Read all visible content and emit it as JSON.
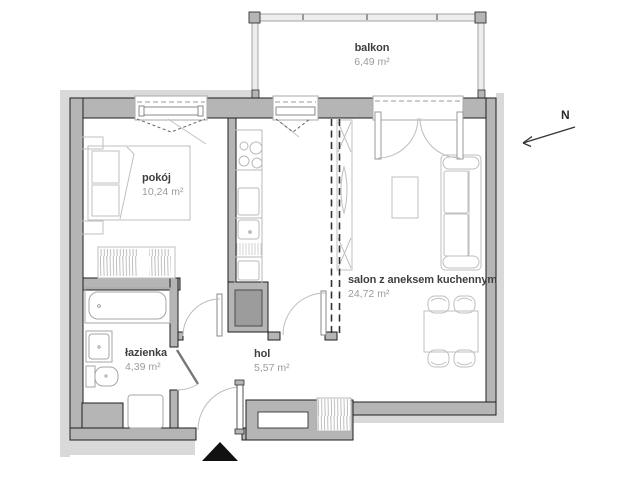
{
  "plan": {
    "rooms": {
      "balkon": {
        "name": "balkon",
        "area": "6,49 m²"
      },
      "pokoj": {
        "name": "pokój",
        "area": "10,24 m²"
      },
      "salon": {
        "name": "salon z aneksem kuchennym",
        "area": "24,72 m²"
      },
      "lazienka": {
        "name": "łazienka",
        "area": "4,39 m²"
      },
      "hol": {
        "name": "hol",
        "area": "5,57 m²"
      }
    },
    "compass": {
      "label": "N"
    },
    "colors": {
      "wall_fill": "#b5b5b5",
      "wall_outline": "#1e1e1e",
      "outer_band": "#d9d9d9",
      "furniture_line": "#bfbfbf",
      "fixture_line": "#a6a6a6",
      "room_name_color": "#3f3f3f",
      "room_area_color": "#9b9b9b",
      "entrance_marker": "#111111"
    }
  }
}
